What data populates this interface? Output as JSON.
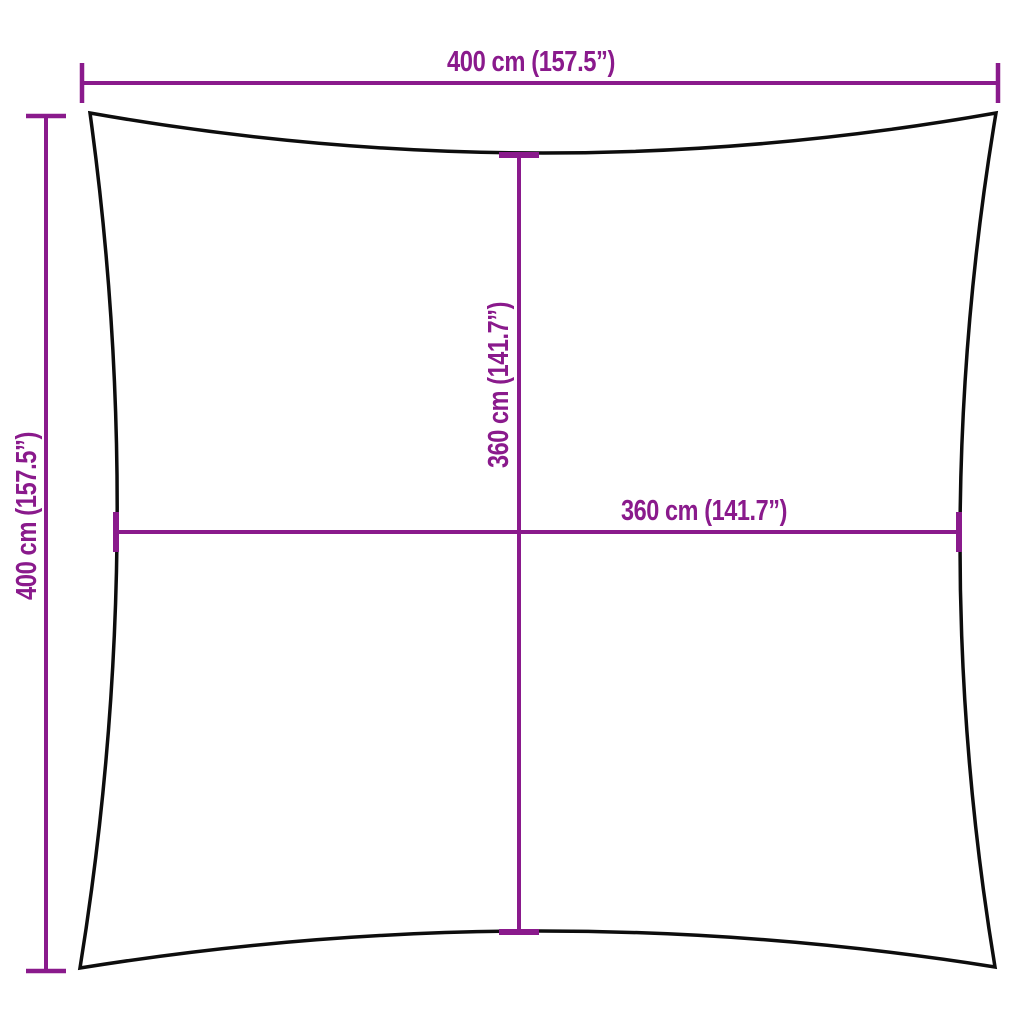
{
  "diagram": {
    "description": "Product dimension diagram of a square shade sail with concave edges and four measurement lines",
    "colors": {
      "dimension": "#8A1A8C",
      "outline": "#0d0d0d",
      "background": "#ffffff"
    },
    "dimensions": {
      "top_width": {
        "label": "400 cm (157.5”)",
        "value_cm": 400,
        "value_in": 157.5
      },
      "left_height": {
        "label": "400 cm (157.5”)",
        "value_cm": 400,
        "value_in": 157.5
      },
      "inner_height": {
        "label": "360 cm (141.7”)",
        "value_cm": 360,
        "value_in": 141.7
      },
      "inner_width": {
        "label": "360 cm (141.7”)",
        "value_cm": 360,
        "value_in": 141.7
      }
    }
  }
}
